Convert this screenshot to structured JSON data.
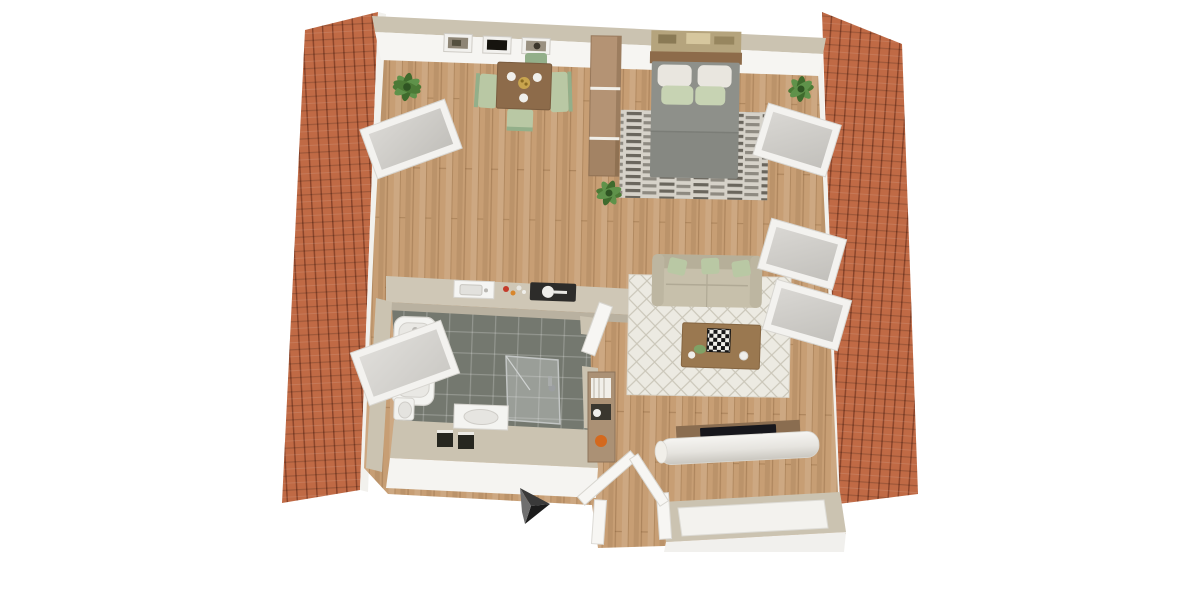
{
  "meta": {
    "title": "3D top-view floor plan of an attic apartment between two sloped tiled roofs",
    "view": "bird's-eye 3d render",
    "visible_text": "none"
  },
  "colors": {
    "background": "#ffffff",
    "roof_base": "#c06a45",
    "eave": "#f2f1ed",
    "floor_wood": "#c79e74",
    "wall_top": "#cbc3b1",
    "wall_face": "#f6f5f2",
    "bath_tile": "#74786f",
    "counter": "#cfc7b6",
    "sanitary_white": "#f4f4f1",
    "sofa": "#c7c0ab",
    "cushion_green": "#b9c8a4",
    "duvet_gray": "#8e908a",
    "pillow_white": "#e9e6df",
    "pillow_green": "#c7d3b3",
    "bed_rug": "#d6d2c9",
    "living_rug": "#eceae2",
    "wood_dark": "#8d6b4a",
    "wardrobe": "#b49374",
    "plant_green": "#4e7c38",
    "arrow_black": "#1c1c1c",
    "glass": "#c9c7c2",
    "niche_dark": "#26261f",
    "shelf_wood": "#ab9175",
    "accent_orange": "#d4691e",
    "tv_black": "#17171c",
    "door_white": "#f7f6f3"
  },
  "structure": {
    "roofs": [
      "left sloped terracotta-tile roof",
      "right sloped terracotta-tile roof"
    ],
    "skylights_left": 2,
    "skylights_right": 3,
    "orientation_arrow": "black chevron pointing right near entrance"
  },
  "rooms": [
    {
      "id": "dining",
      "label": "Dining area",
      "furniture": [
        "square wooden table",
        "4 green chairs",
        "3 framed wall pictures",
        "plant"
      ]
    },
    {
      "id": "bedroom",
      "label": "Sleeping area",
      "furniture": [
        "double bed with gray duvet",
        "2 white + 2 green pillows",
        "wall art above headboard",
        "striped gray rug",
        "tall wooden wardrobe",
        "plants"
      ]
    },
    {
      "id": "living",
      "label": "Living area",
      "furniture": [
        "beige sofa with 3 green cushions",
        "white diamond-pattern rug",
        "wooden coffee table with chessboard",
        "white TV sideboard with flat TV"
      ]
    },
    {
      "id": "kitchen",
      "label": "Kitchenette",
      "furniture": [
        "counter on bathroom wall",
        "sink",
        "fruit",
        "dark cooktop with pan"
      ]
    },
    {
      "id": "bathroom",
      "label": "Bathroom",
      "furniture": [
        "bathtub",
        "glass shower",
        "washbasin",
        "toilet",
        "open door",
        "two dark wall niches"
      ]
    },
    {
      "id": "hall",
      "label": "Entrance hall",
      "furniture": [
        "open double entrance door",
        "shelf with books, paper roll and orange ball"
      ]
    }
  ]
}
